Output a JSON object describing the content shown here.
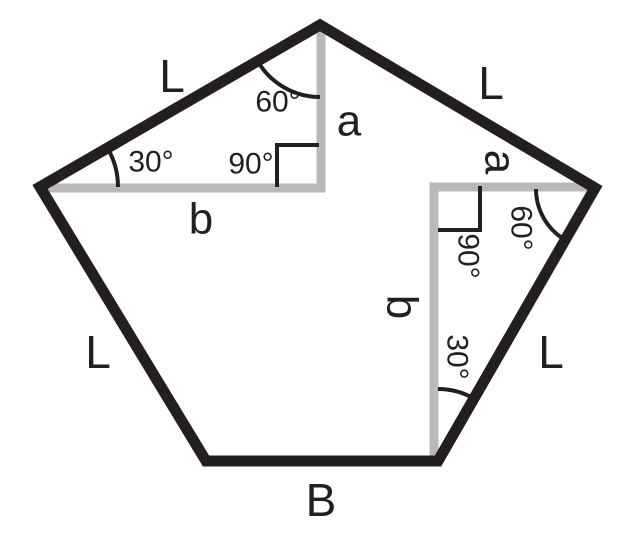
{
  "colors": {
    "edge": "#231f20",
    "construction": "#b9b9b9",
    "text": "#231f20",
    "background": "#ffffff"
  },
  "sides": {
    "top_left": "L",
    "top_right": "L",
    "bottom_left": "L",
    "bottom_right": "L",
    "base": "B"
  },
  "segments": {
    "apothem_top": "a",
    "apothem_right": "a",
    "half_base_left": "b",
    "half_base_right": "b"
  },
  "angles": {
    "top_vertex": "60°",
    "left_vertex": "30°",
    "left_right_angle": "90°",
    "right_vertex": "60°",
    "right_right_angle": "90°",
    "bottom_right_vertex": "30°"
  }
}
